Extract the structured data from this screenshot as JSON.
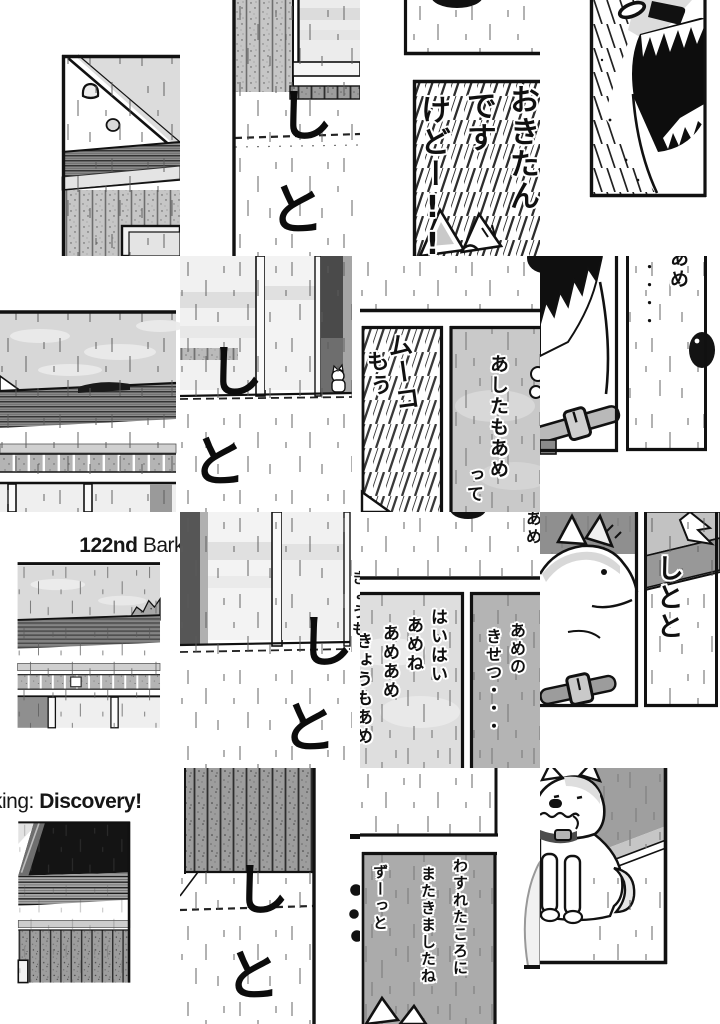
{
  "title": {
    "chapter_number": "122nd",
    "chapter_word": "Bark",
    "title_cont_prefix": "king:",
    "title_cont_word": "Discovery!"
  },
  "speech": {
    "wake_shout_col1": "おきたん",
    "wake_shout_col2": "です",
    "wake_shout_col3": "けどー!!",
    "muko": "ムーコ",
    "mou": "もう",
    "ashita_col1": "あしたもあめ",
    "ashita_col2": "って",
    "ame": "あめ",
    "ellipsis_dots": "・・・・",
    "haihai_col1": "はいはい",
    "haihai_col2": "あめね",
    "haihai_col3": "あめあめ",
    "haihai_col4": "きょうもあめ",
    "season_col1": "あめの",
    "season_col2": "きせつ・・・",
    "returned_col1": "わすれたころに",
    "returned_col2": "またきましたね",
    "returned_col3": "ずーっと",
    "edge_partial_kyoumo": "きょうも",
    "edge_partial_ame": "あめ"
  },
  "sfx": {
    "shi": "し",
    "to": "と",
    "shitoto": "しとと"
  }
}
